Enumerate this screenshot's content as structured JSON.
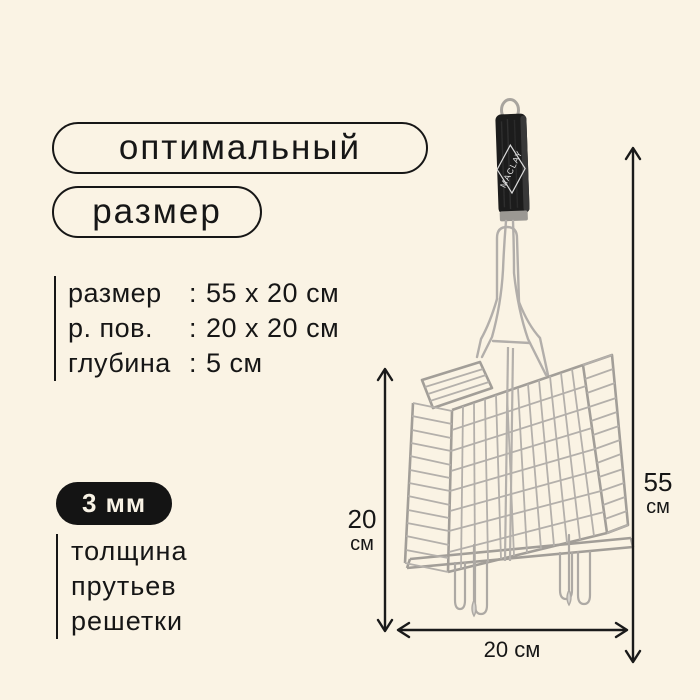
{
  "page": {
    "background": "#faf3e4",
    "ink": "#161616"
  },
  "badges": {
    "title_line1": "оптимальный",
    "title_line2": "размер"
  },
  "specs": {
    "rows": [
      {
        "label": "размер",
        "colon": ":",
        "value": "55 x 20 см"
      },
      {
        "label": "р. пов.",
        "colon": ":",
        "value": "20 x 20 см"
      },
      {
        "label": "глубина",
        "colon": ":",
        "value": "5 см"
      }
    ]
  },
  "thickness": {
    "badge": "3 мм",
    "line1": "толщина",
    "line2": "прутьев",
    "line3": "решетки"
  },
  "product": {
    "brand": "MACLAY",
    "handle_color": "#1c1c1c",
    "wire_color": "#b2aeaa",
    "badge_bg": "#141414"
  },
  "dims": {
    "left": {
      "value": "20",
      "unit": "см"
    },
    "right": {
      "value": "55",
      "unit": "см"
    },
    "bottom": {
      "value": "20 см"
    }
  }
}
